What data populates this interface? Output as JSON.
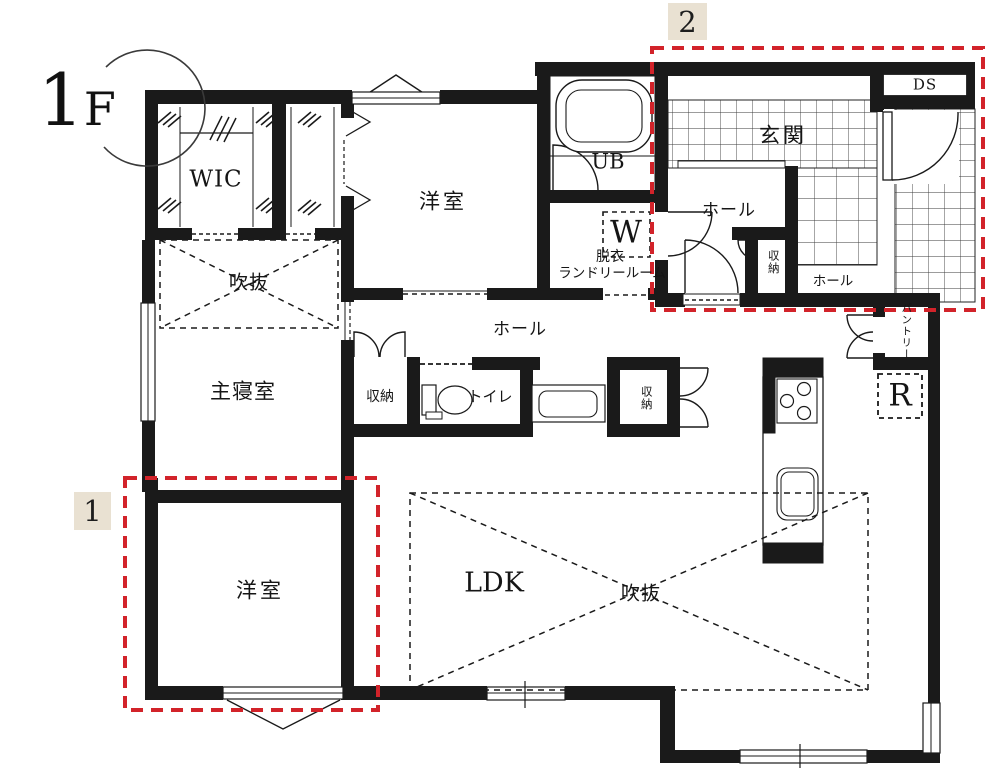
{
  "floor_badge": {
    "number": "1",
    "suffix": "F"
  },
  "markers": {
    "one": "1",
    "two": "2"
  },
  "labels": {
    "wic": "WIC",
    "bedroom_upper": "洋室",
    "ub": "UB",
    "washer": "W",
    "datsui": "脱衣",
    "laundry_room": "ランドリールーム",
    "genkan": "玄関",
    "ds": "DS",
    "hall_entrance": "ホール",
    "storage_entrance": "収納",
    "hall_genkan": "ホール",
    "pantry": "パントリー",
    "fridge": "R",
    "void_upper": "吹抜",
    "master_bedroom": "主寝室",
    "storage_hall_left": "収納",
    "toilet": "トイレ",
    "hall_middle": "ホール",
    "storage_hall_right": "収納",
    "bedroom_lower": "洋室",
    "ldk": "LDK",
    "void_lower": "吹抜"
  },
  "colors": {
    "wall": "#1a1a1a",
    "highlight_red": "#d2232a",
    "marker_bg": "#e9e1d2"
  }
}
